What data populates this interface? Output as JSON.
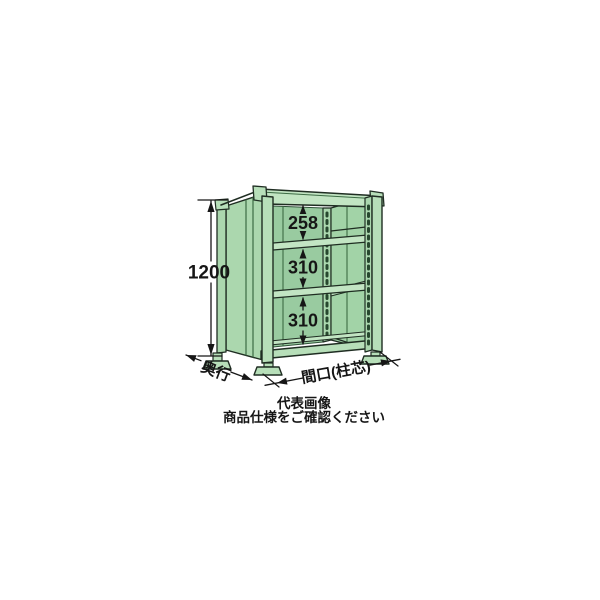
{
  "drawing": {
    "type": "product-dimension-diagram",
    "subject": "green-steel-shelving-rack",
    "height_mm": "1200",
    "spacings": [
      "258",
      "310",
      "310"
    ],
    "depth_label": "奥行",
    "width_label": "間口(柱芯)",
    "colors": {
      "body_green": "#abd7ae",
      "post_green": "#b7dfb9",
      "panel_green": "#99cba0",
      "highlight_green": "#c2e5c3",
      "seam_green": "#3c6b44",
      "outline": "#1f2d22",
      "dimension_ink": "#161616"
    }
  },
  "caption": {
    "line1": "代表画像",
    "line2": "商品仕様をご確認ください"
  }
}
